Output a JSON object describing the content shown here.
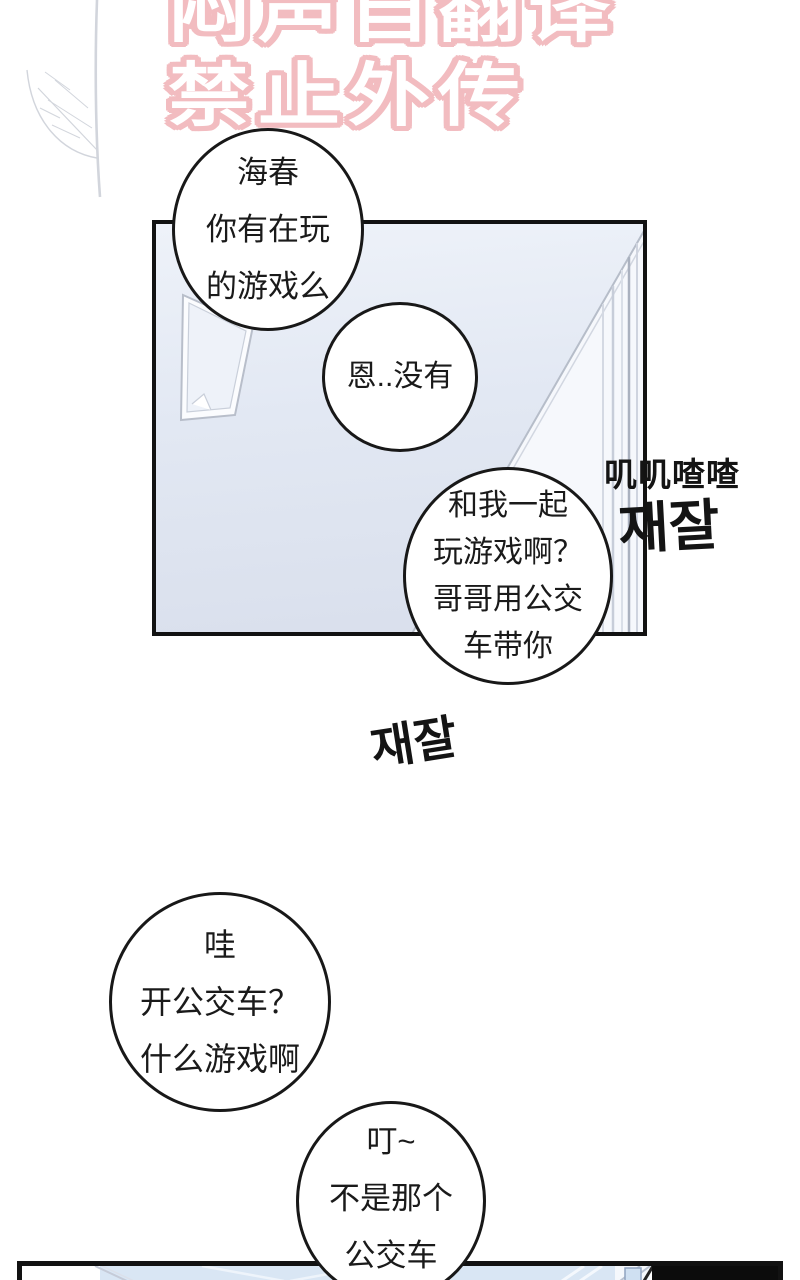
{
  "watermark": {
    "line1": "闷声自翻译",
    "line2": "禁止外传",
    "color": "#f2bcc0"
  },
  "panel1": {
    "sfx_chinese": "叽叽喳喳",
    "sfx_korean_top": "재잘",
    "sfx_korean_left": "재잘"
  },
  "bubbles": [
    {
      "id": "bubble-1",
      "lines": [
        "海春",
        "你有在玩",
        "的游戏么"
      ]
    },
    {
      "id": "bubble-2",
      "lines": [
        "恩..没有"
      ]
    },
    {
      "id": "bubble-3",
      "lines": [
        "和我一起",
        "玩游戏啊？",
        "哥哥用公交",
        "车带你"
      ]
    },
    {
      "id": "bubble-4",
      "lines": [
        "哇",
        "开公交车？",
        "什么游戏啊"
      ]
    },
    {
      "id": "bubble-5",
      "lines": [
        "叮~",
        "不是那个",
        "公交车"
      ]
    }
  ],
  "colors": {
    "panel_bg_top": "#eef2f9",
    "panel_bg_bottom": "#d9dfec",
    "panel_border": "#121212",
    "bubble_border": "#181818",
    "bottom_panel_blue": "#d9e6f4",
    "bottom_panel_black": "#0c0c0c"
  }
}
